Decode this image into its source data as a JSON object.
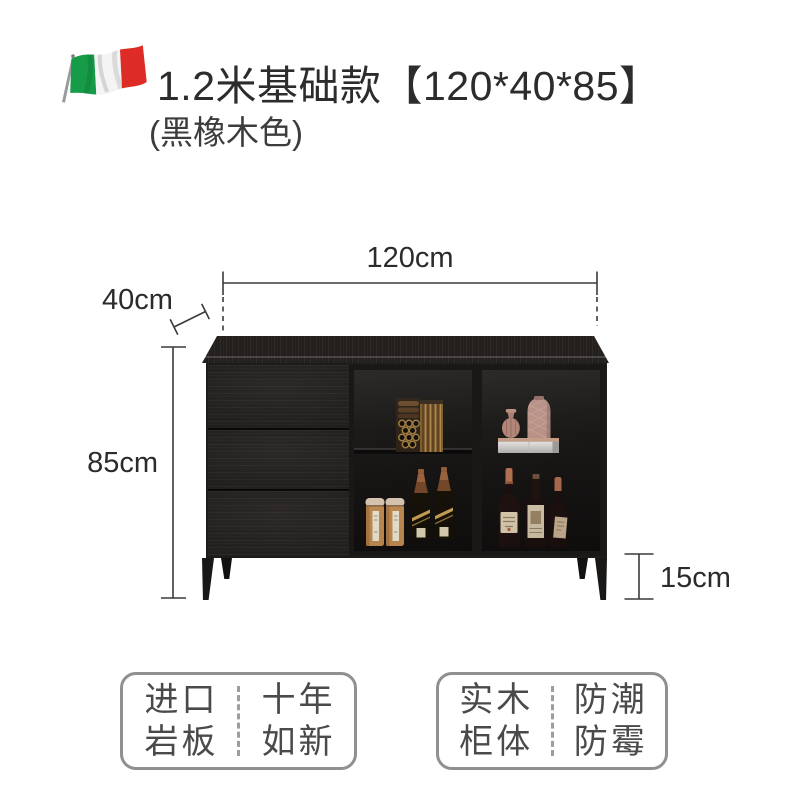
{
  "header": {
    "title": "1.2米基础款【120*40*85】",
    "subtitle": "(黑橡木色)",
    "flag_icon": "italy-flag"
  },
  "dimensions": {
    "width": "120cm",
    "depth": "40cm",
    "height": "85cm",
    "leg_height": "15cm"
  },
  "feature_badges": [
    {
      "left": [
        "进口",
        "岩板"
      ],
      "right": [
        "十年",
        "如新"
      ]
    },
    {
      "left": [
        "实木",
        "柜体"
      ],
      "right": [
        "防潮",
        "防霉"
      ]
    }
  ],
  "colors": {
    "flag_green": "#169b48",
    "flag_white": "#f4f4f4",
    "flag_red": "#dd2c25",
    "title_text": "#2c2c2c",
    "dimension_text": "#2b2b2b",
    "dimension_line": "#3a3a3a",
    "badge_border": "#909090",
    "badge_text": "#4a4a4a",
    "cabinet_black": "#211e1c"
  }
}
